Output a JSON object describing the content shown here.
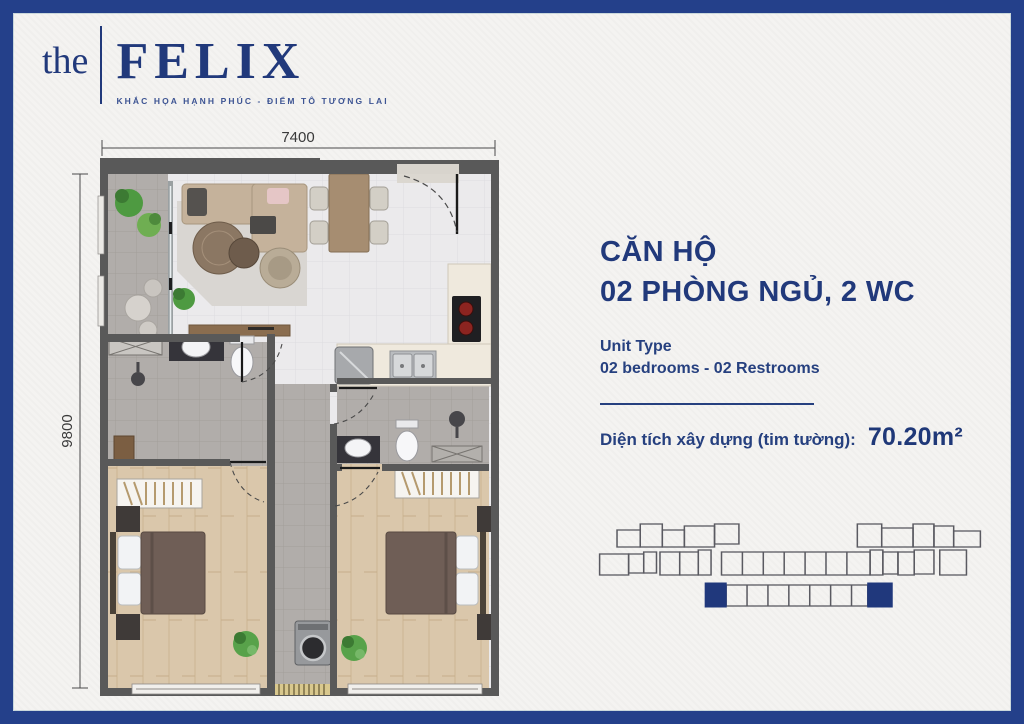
{
  "page": {
    "background_color": "#f4f3f1",
    "frame_color": "#24408a",
    "accent_color": "#21397b"
  },
  "logo": {
    "prefix": "the",
    "name": "FELIX",
    "tagline": "KHẮC HỌA HẠNH PHÚC - ĐIỂM TÔ TƯƠNG LAI"
  },
  "floor_plan": {
    "width_dimension": "7400",
    "height_dimension": "9800"
  },
  "unit_info": {
    "title_line1": "CĂN HỘ",
    "title_line2": "02 PHÒNG NGỦ, 2 WC",
    "unit_type_label": "Unit Type",
    "unit_type_value": "02 bedrooms - 02 Restrooms",
    "area_label": "Diện tích xây dựng (tim tường):",
    "area_value": "70.20m²"
  },
  "keyplan": {
    "highlight_color": "#20387c",
    "outline_color": "#5a5a61",
    "highlighted_units": 2
  }
}
